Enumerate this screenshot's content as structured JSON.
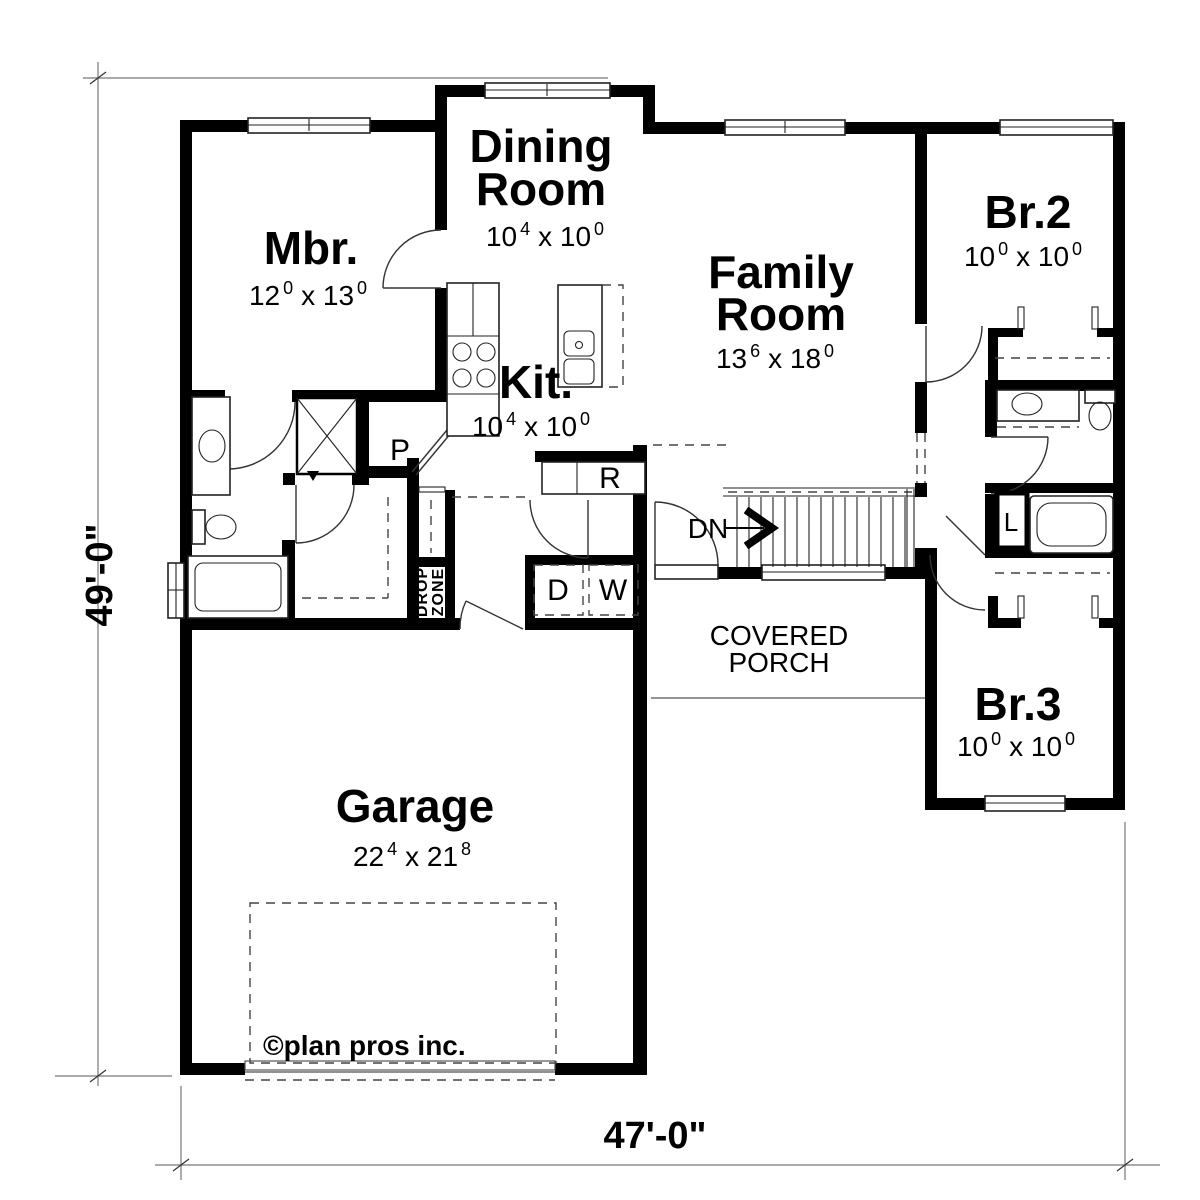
{
  "plan_title": "First floor plan",
  "dimensions": {
    "left": "49'-0\"",
    "bottom": "47'-0\""
  },
  "rooms": {
    "mbr": {
      "name": "Mbr.",
      "dim": {
        "d1": "12",
        "s1": "0",
        "d2": "x 13",
        "s2": "0"
      }
    },
    "dining": {
      "name1": "Dining",
      "name2": "Room",
      "dim": {
        "d1": "10",
        "s1": "4",
        "d2": "x 10",
        "s2": "0"
      }
    },
    "kitchen": {
      "name": "Kit.",
      "dim": {
        "d1": "10",
        "s1": "4",
        "d2": "x 10",
        "s2": "0"
      }
    },
    "family": {
      "name1": "Family",
      "name2": "Room",
      "dim": {
        "d1": "13",
        "s1": "6",
        "d2": "x 18",
        "s2": "0"
      }
    },
    "br2": {
      "name": "Br.2",
      "dim": {
        "d1": "10",
        "s1": "0",
        "d2": "x 10",
        "s2": "0"
      }
    },
    "br3": {
      "name": "Br.3",
      "dim": {
        "d1": "10",
        "s1": "0",
        "d2": "x 10",
        "s2": "0"
      }
    },
    "garage": {
      "name": "Garage",
      "dim": {
        "d1": "22",
        "s1": "4",
        "d2": "x 21",
        "s2": "8"
      }
    },
    "porch": {
      "name1": "COVERED",
      "name2": "PORCH"
    }
  },
  "labels": {
    "pantry": "P",
    "refrigerator": "R",
    "dryer": "D",
    "washer": "W",
    "linen": "L",
    "stairs_down": "DN",
    "drop_zone_line1": "DROP",
    "drop_zone_line2": "ZONE"
  },
  "copyright": "©plan pros inc.",
  "colors": {
    "wall": "#000000",
    "background": "#ffffff",
    "thin_line": "#222222",
    "dashed_line": "#444444",
    "dimension_line": "#777777"
  }
}
